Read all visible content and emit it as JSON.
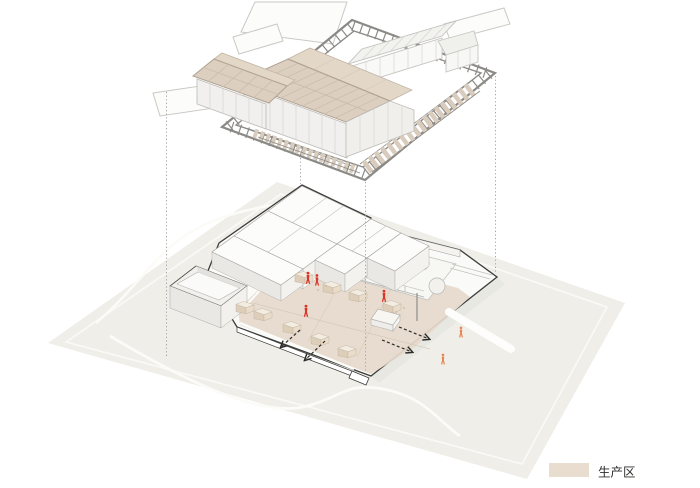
{
  "legend": {
    "items": [
      {
        "label": "生产区",
        "swatch_color": "#e9ddd0"
      }
    ]
  },
  "colors": {
    "ground": "#efeee8",
    "site-outline": "#3b3b39",
    "frame-gray": "#8b8a86",
    "roof-beige": "#dccfc0",
    "roof-beige-light": "#e3d7c8",
    "wall-white": "#f1f0ee",
    "floor-beige": "#e5d9cb",
    "path-white": "#fbfbf8",
    "worker-red": "#dc3327",
    "visitor-orange": "#e8834e",
    "legend-text": "#2f2f2d"
  },
  "counts": {
    "red_worker_figures": 4,
    "orange_outdoor_figures": 2,
    "exit_arrows_left": 2,
    "exit_arrows_right": 2,
    "connector_lines": 4
  }
}
